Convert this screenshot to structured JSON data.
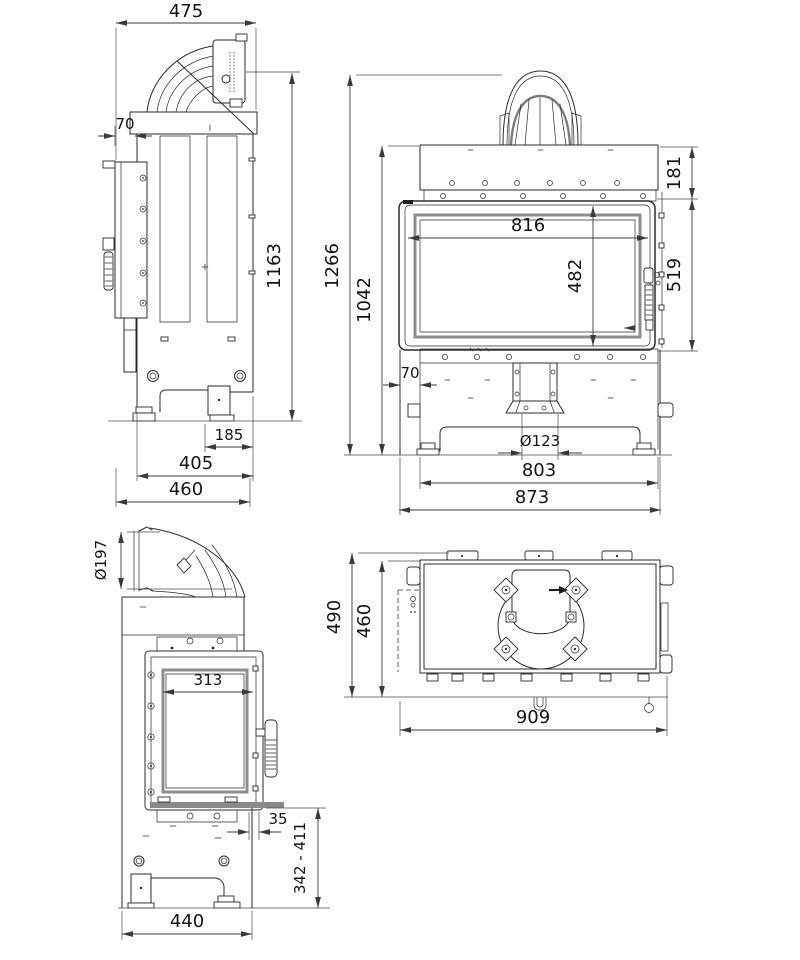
{
  "drawing": {
    "type": "technical-orthographic-views",
    "subject": "fireplace insert with corner side glass",
    "background": "#ffffff",
    "line_color": "#2b2b2b",
    "views": {
      "side_view": {
        "label": "side view (left top)",
        "dims": {
          "total_width": "475",
          "frame_offset": "70",
          "height_to_flue_top": "1163",
          "rear_leg_offset": "185",
          "body_depth": "405",
          "overall_depth": "460"
        }
      },
      "front_view": {
        "label": "front view (right top)",
        "dims": {
          "overall_height": "1266",
          "body_height": "1042",
          "hood_height": "181",
          "glass_width": "816",
          "glass_height": "482",
          "door_height": "519",
          "left_offset": "70",
          "flue_spigot_diameter": "Ø123",
          "body_width": "803",
          "overall_width": "873"
        }
      },
      "side_glass_view": {
        "label": "side view with glazing (left bottom)",
        "dims": {
          "flue_diameter": "Ø197",
          "side_glass_width": "313",
          "door_protrusion": "35",
          "leg_height_range": "342 - 411",
          "overall_depth": "440"
        }
      },
      "top_view": {
        "label": "top view (right bottom)",
        "dims": {
          "overall_depth": "490",
          "body_depth": "460",
          "overall_width": "909"
        }
      }
    }
  }
}
